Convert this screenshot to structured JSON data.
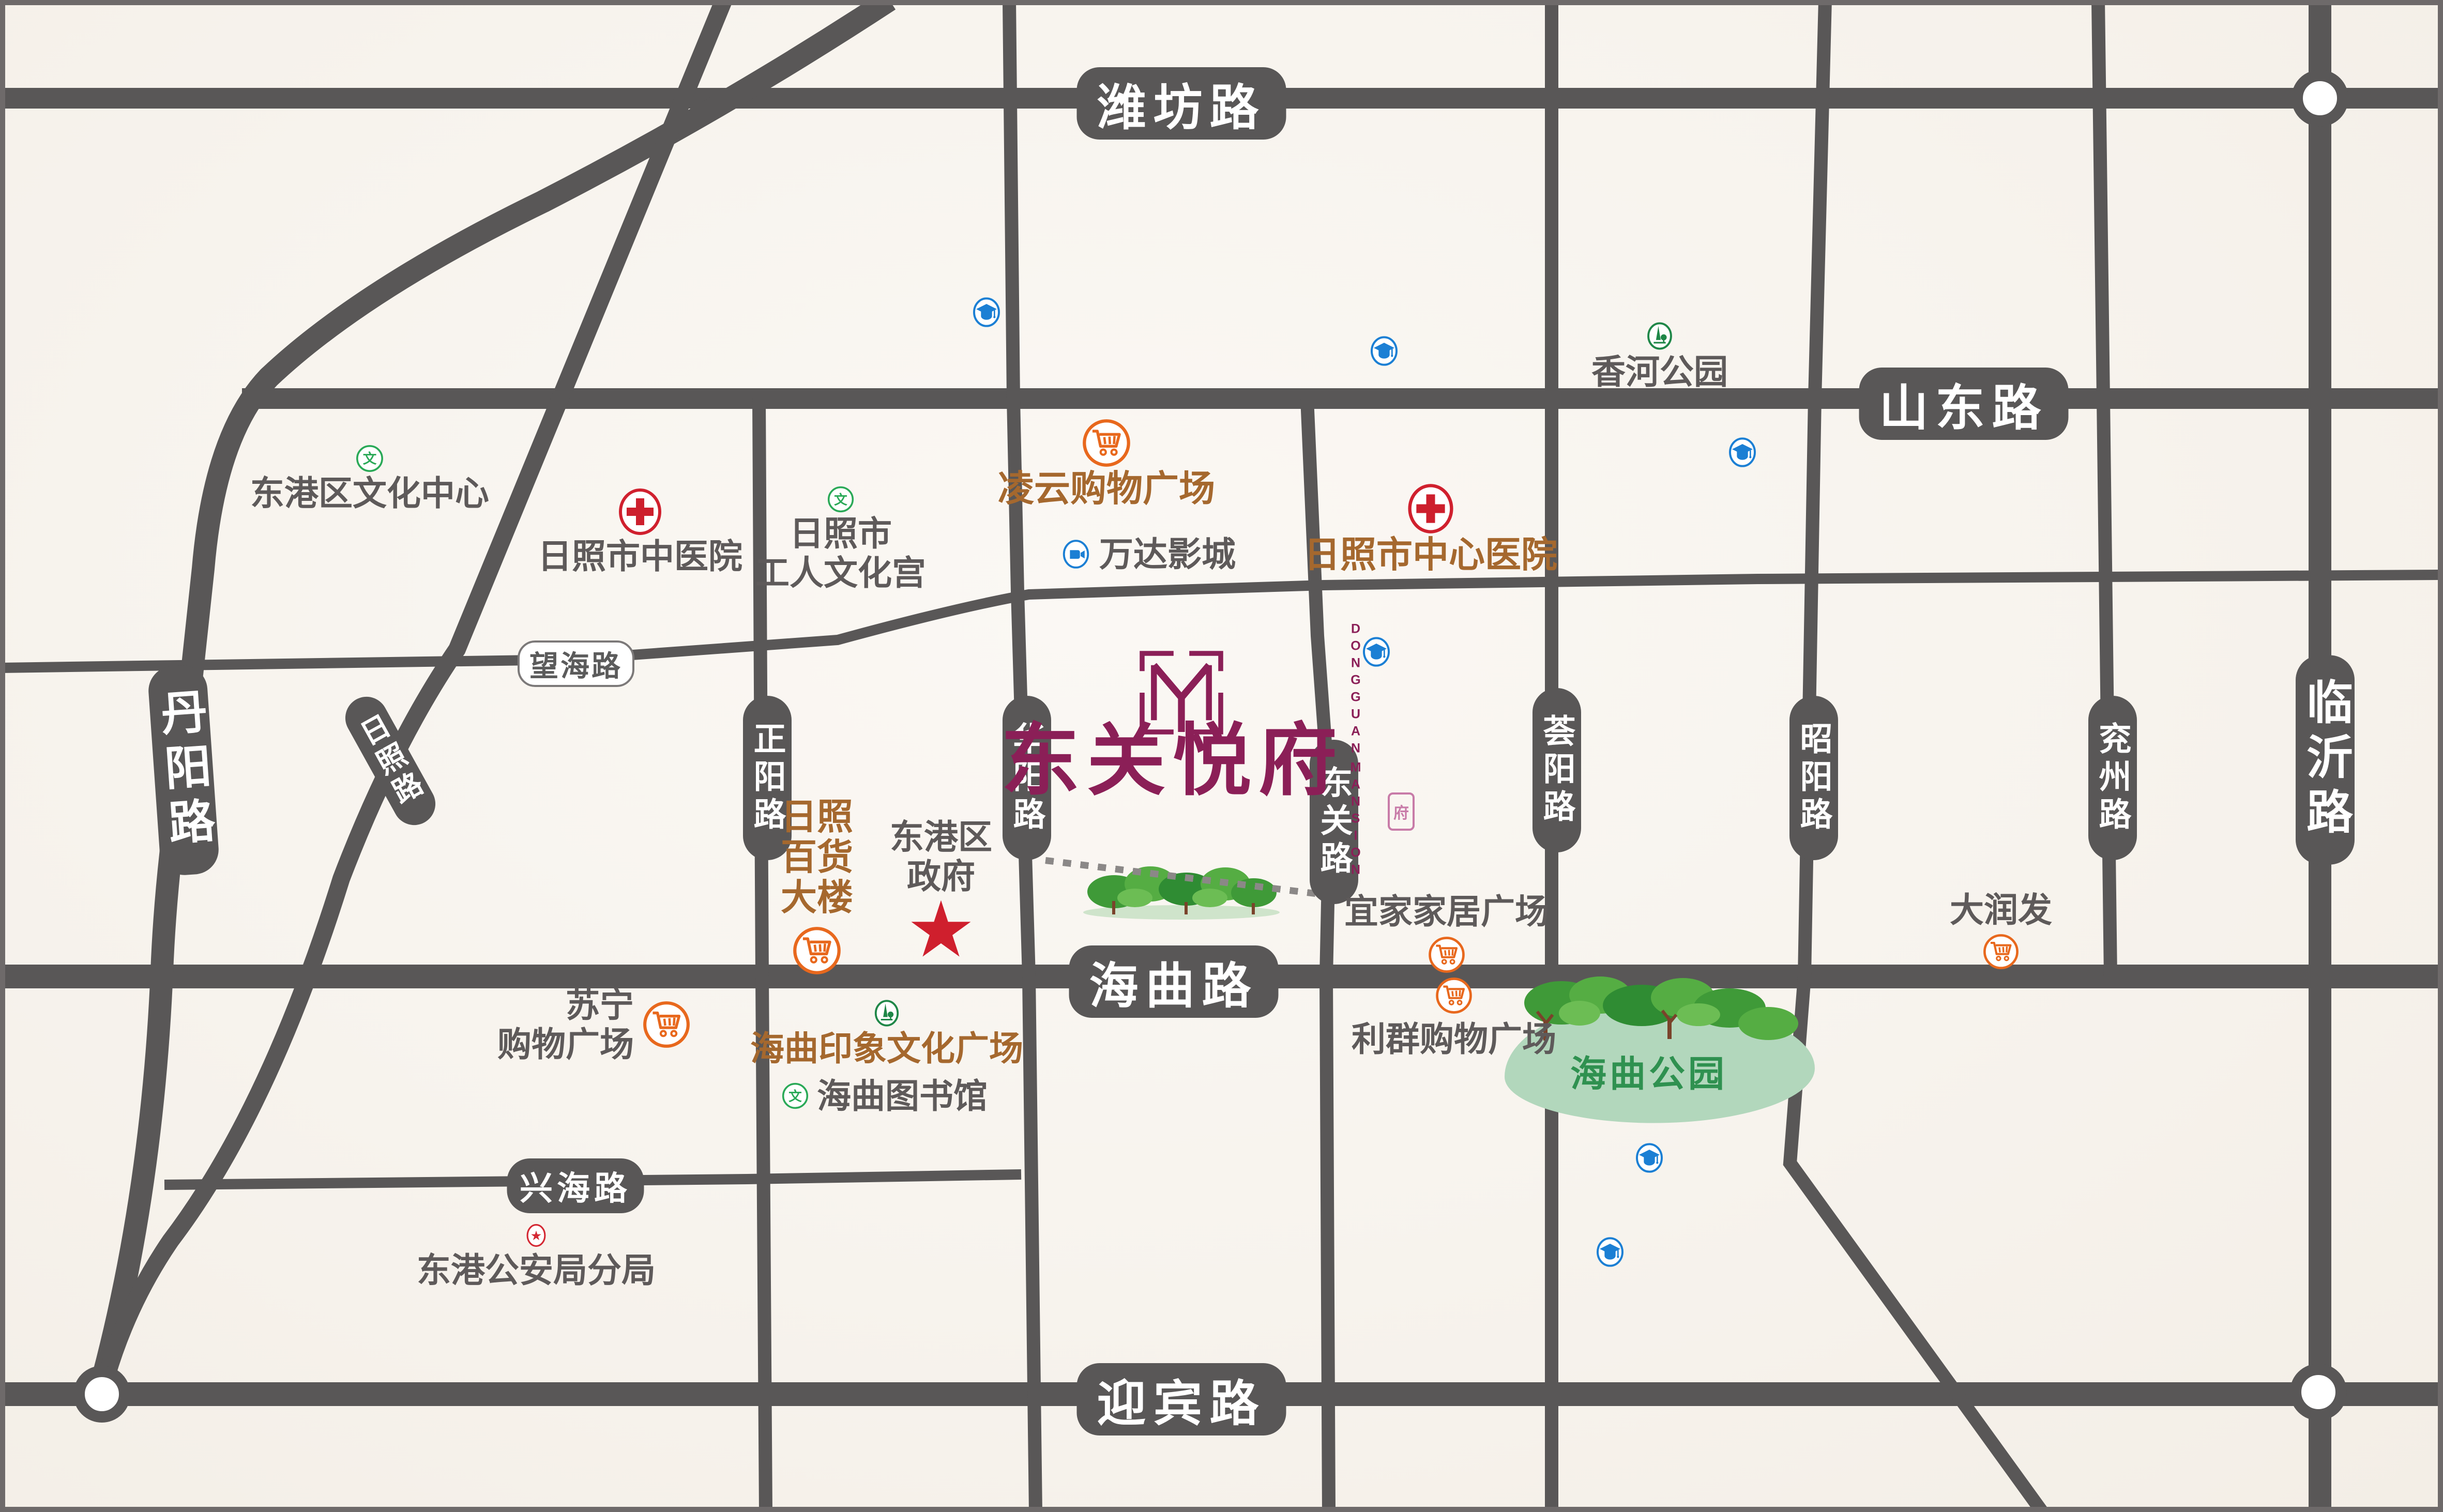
{
  "map": {
    "background": "#f7f3ed",
    "road_color": "#595757",
    "frame_color": "#6e6a6a"
  },
  "colors": {
    "road_label_bg": "#595757",
    "poi_text": "#5e5a5a",
    "poi_brown": "#a5682e",
    "shopping_orange": "#e8681d",
    "hospital_red": "#d0202e",
    "education_blue": "#1b7fd4",
    "culture_green": "#2aa957",
    "park_green": "#1f8748",
    "park_text_green": "#2f9150",
    "police_red": "#d42833",
    "gov_star_red": "#cf1f2d",
    "logo_plum": "#8b1f57",
    "park_blob": "#b2d7bc",
    "boundary_dot_gray": "#8b8887"
  },
  "roads": {
    "weifang": "潍坊路",
    "shandong": "山东路",
    "wanghai": "望海路",
    "haiqu": "海曲路",
    "xinghai": "兴海路",
    "yingbin": "迎宾路",
    "danyang": "丹阳路",
    "rizhao": "日照路",
    "zhengyang": "正阳路",
    "huayang": "华阳路",
    "dongguan": "东关路",
    "huiyang": "荟阳路",
    "zhaoyang": "昭阳路",
    "yanzhou": "兖州路",
    "linyi": "临沂路"
  },
  "logo": {
    "monogram": "M",
    "name": "东关悦府",
    "english_col1": "DONGGUAN",
    "english_col2": "MANSION",
    "seal": "府"
  },
  "pois": {
    "culture_center": {
      "label": "东港区文化中心",
      "icon": "culture-icon"
    },
    "tcm_hospital": {
      "label": "日照市中医院",
      "icon": "hospital-icon"
    },
    "workers_palace": {
      "label": "日照市\n工人文化宫",
      "icon": "culture-icon"
    },
    "lingyun_plaza": {
      "label": "凌云购物广场",
      "icon": "shopping-cart-icon"
    },
    "wanda_cinema": {
      "label": "万达影城",
      "icon": "cinema-icon"
    },
    "central_hospital": {
      "label": "日照市中心医院",
      "icon": "hospital-icon"
    },
    "xianghe_park": {
      "label": "香河公园",
      "icon": "park-icon"
    },
    "department_store": {
      "label": "日照\n百货\n大楼",
      "icon": "shopping-cart-icon"
    },
    "district_gov": {
      "label": "东港区\n政府",
      "icon": "star-icon",
      "star": "★"
    },
    "yijia_plaza": {
      "label": "宜家家居广场",
      "icon": "shopping-cart-icon"
    },
    "liqun_plaza": {
      "label": "利群购物广场",
      "icon": "shopping-cart-icon"
    },
    "haiqu_park": {
      "label": "海曲公园",
      "icon": "park-trees"
    },
    "darunfa": {
      "label": "大润发",
      "icon": "shopping-cart-icon"
    },
    "suning_plaza": {
      "label": "苏宁\n购物广场",
      "icon": "shopping-cart-icon"
    },
    "haiqu_impression": {
      "label": "海曲印象文化广场",
      "icon": "park-icon"
    },
    "haiqu_library": {
      "label": "海曲图书馆",
      "icon": "culture-icon"
    },
    "police_branch": {
      "label": "东港公安局分局",
      "icon": "police-star-icon",
      "star": "★"
    }
  },
  "icon_glyphs": {
    "culture_char": "文"
  }
}
